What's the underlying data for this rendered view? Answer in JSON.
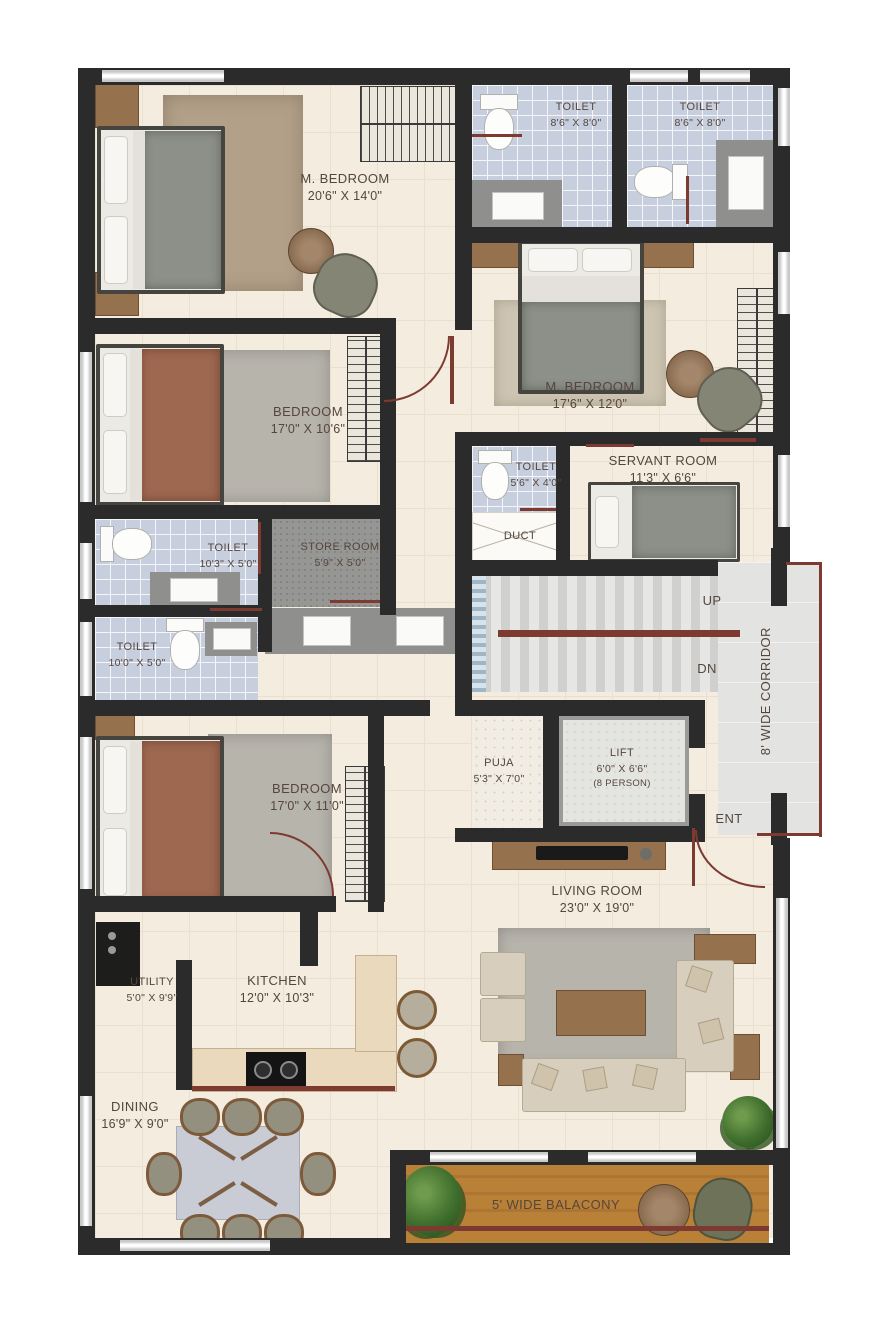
{
  "rooms": {
    "master_bedroom_1": {
      "name": "M. BEDROOM",
      "dims": "20'6\" X 14'0\""
    },
    "toilet_top_left": {
      "name": "TOILET",
      "dims": "8'6\" X 8'0\""
    },
    "toilet_top_right": {
      "name": "TOILET",
      "dims": "8'6\" X 8'0\""
    },
    "master_bedroom_2": {
      "name": "M. BEDROOM",
      "dims": "17'6\" X 12'0\""
    },
    "bedroom_1": {
      "name": "BEDROOM",
      "dims": "17'0\" X 10'6\""
    },
    "toilet_servant": {
      "name": "TOILET",
      "dims": "5'6\" X 4'0\""
    },
    "servant_room": {
      "name": "SERVANT ROOM",
      "dims": "11'3\" X 6'6\""
    },
    "toilet_mid": {
      "name": "TOILET",
      "dims": "10'3\" X 5'0\""
    },
    "store_room": {
      "name": "STORE ROOM",
      "dims": "5'9\" X 5'0\""
    },
    "duct": {
      "name": "DUCT"
    },
    "toilet_lower": {
      "name": "TOILET",
      "dims": "10'0\" X 5'0\""
    },
    "stairs_up": {
      "name": "UP"
    },
    "stairs_dn": {
      "name": "DN"
    },
    "corridor": {
      "name": "8' WIDE CORRIDOR"
    },
    "puja": {
      "name": "PUJA",
      "dims": "5'3\" X 7'0\""
    },
    "lift": {
      "name": "LIFT",
      "dims": "6'0\" X 6'6\"",
      "capacity": "(8 PERSON)"
    },
    "entrance": {
      "name": "ENT"
    },
    "bedroom_2": {
      "name": "BEDROOM",
      "dims": "17'0\" X 11'0\""
    },
    "living_room": {
      "name": "LIVING ROOM",
      "dims": "23'0\" X 19'0\""
    },
    "utility": {
      "name": "UTILITY",
      "dims": "5'0\" X 9'9\""
    },
    "kitchen": {
      "name": "KITCHEN",
      "dims": "12'0\" X 10'3\""
    },
    "dining": {
      "name": "DINING",
      "dims": "16'9\" X 9'0\""
    },
    "balcony": {
      "name": "5' WIDE BALACONY"
    }
  },
  "colors": {
    "wall": "#2b2b2b",
    "floor": "#f3ecdf",
    "toilet_floor": "#c7cfdf",
    "stair_floor": "#dcdcdb",
    "balcony_wood": "#d8b377",
    "door_accent": "#7d3a31"
  }
}
